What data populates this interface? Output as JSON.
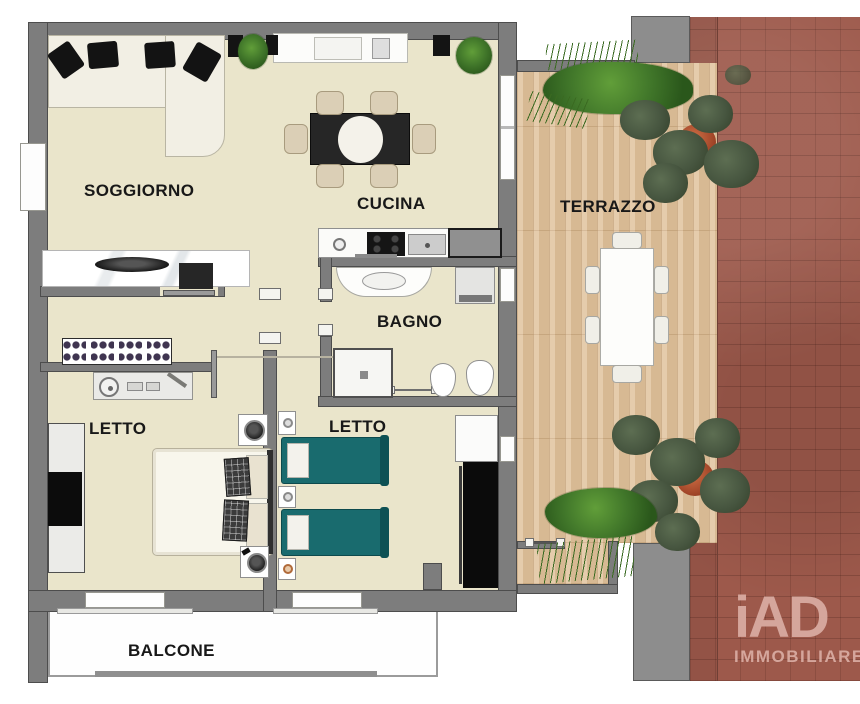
{
  "floorplan": {
    "labels": {
      "soggiorno": "SOGGIORNO",
      "cucina": "CUCINA",
      "terrazzo": "TERRAZZO",
      "bagno": "BAGNO",
      "letto1": "LETTO",
      "letto2": "LETTO",
      "balcone": "BALCONE"
    },
    "watermark": {
      "brand": "iAD",
      "subtitle": "IMMOBILIARE",
      "color": "#d9aba1"
    },
    "colors": {
      "interior_floor": "#eae5cb",
      "wall_gray": "#7d7d7d",
      "deck_wood": "#e0c29c",
      "brick_red": "#9d594b",
      "bed_teal": "#196b6e",
      "plant_green": "#41772a",
      "tree_foliage": "#475640",
      "pot_terracotta": "#a4482a"
    }
  }
}
